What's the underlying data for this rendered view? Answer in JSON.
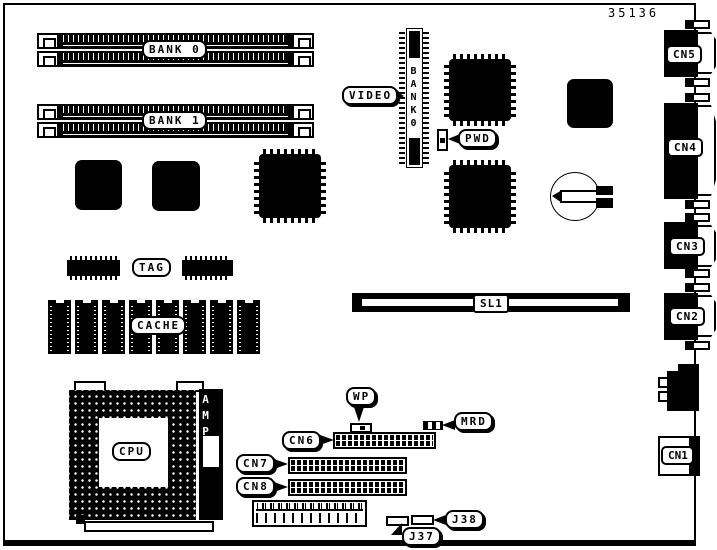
{
  "page": {
    "part_number": "35136"
  },
  "memory": {
    "bank0": "BANK 0",
    "bank1": "BANK 1"
  },
  "video": {
    "label": "VIDEO",
    "slot": "BANK0"
  },
  "jumpers": {
    "pwd": "PWD",
    "wp": "WP",
    "mrd": "MRD"
  },
  "cache": {
    "tag": "TAG",
    "label": "CACHE"
  },
  "slots": {
    "sl1": "SL1"
  },
  "cpu": {
    "label": "CPU",
    "amp": "AMP"
  },
  "headers": {
    "cn6": "CN6",
    "cn7": "CN7",
    "cn8": "CN8",
    "j37": "J37",
    "j38": "J38"
  },
  "rear_connectors": {
    "cn5": "CN5",
    "cn4": "CN4",
    "cn3": "CN3",
    "cn2": "CN2",
    "cn1": "CN1"
  },
  "colors": {
    "ink": "#000000",
    "paper": "#ffffff"
  }
}
